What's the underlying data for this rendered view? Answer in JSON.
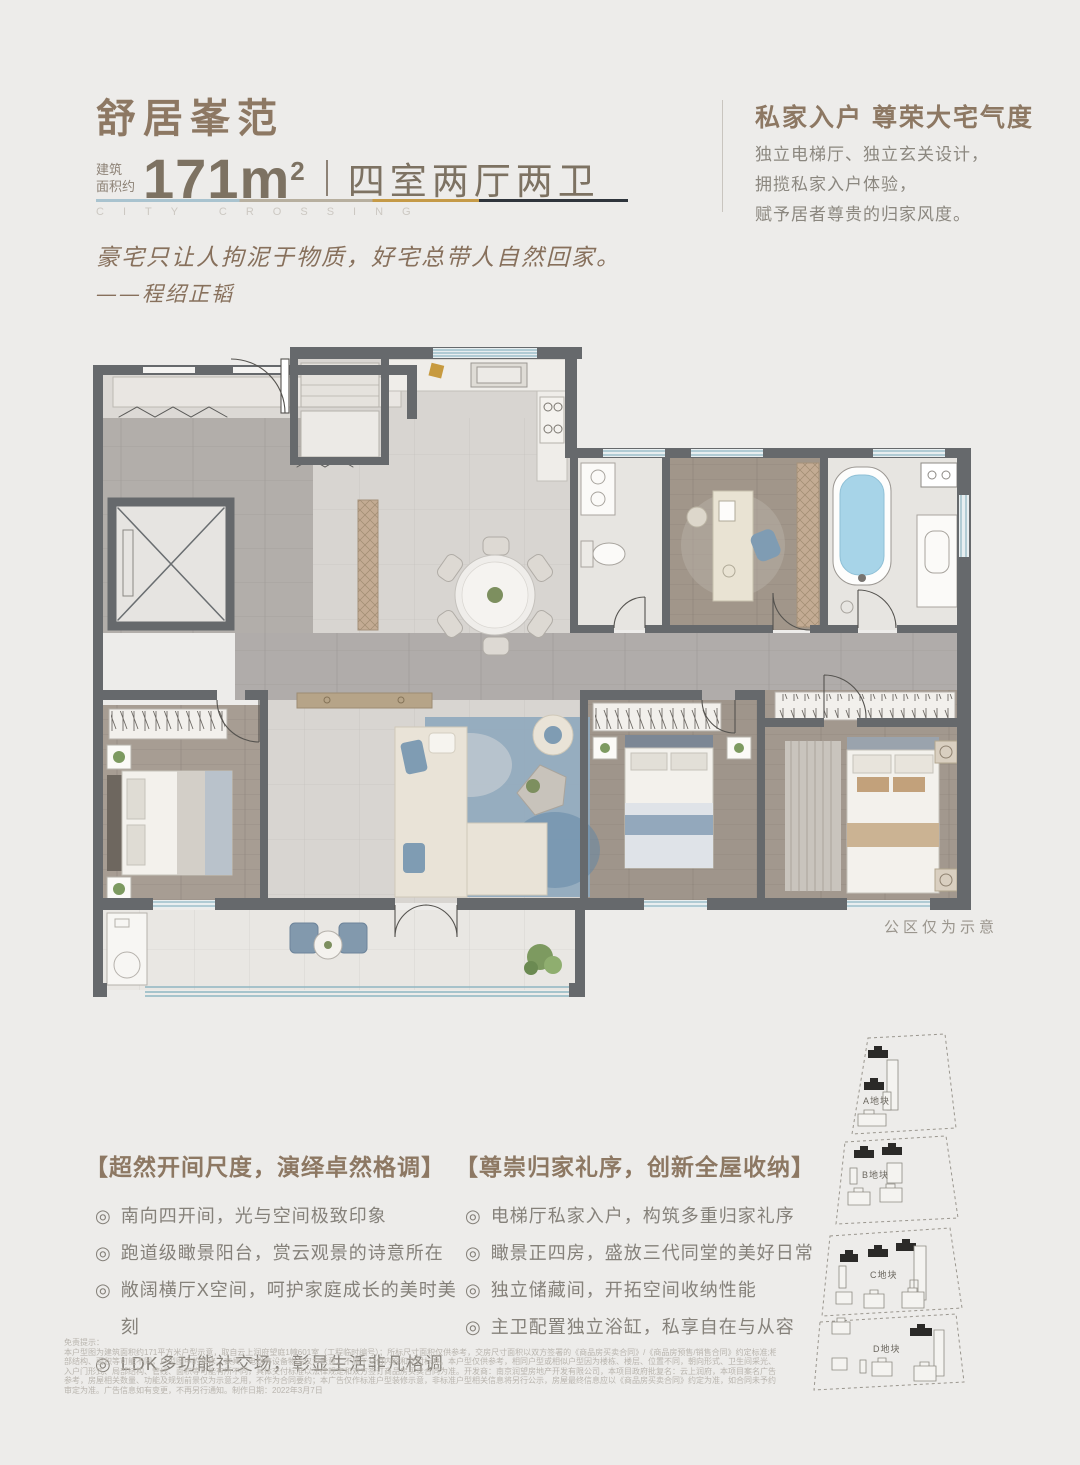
{
  "header": {
    "title": "舒居峯范",
    "area_prefix_line1": "建筑",
    "area_prefix_line2": "面积约",
    "area_value": "171m",
    "area_sup": "2",
    "layout": "四室两厅两卫",
    "watermark": "CITY CROSSING",
    "quote": "豪宅只让人拘泥于物质，好宅总带人自然回家。",
    "quote_author": "——程绍正韬"
  },
  "highlight": {
    "title": "私家入户 尊荣大宅气度",
    "line1": "独立电梯厅、独立玄关设计，",
    "line2": "拥揽私家入户体验，",
    "line3": "赋予居者尊贵的归家风度。"
  },
  "floorplan": {
    "note": "公区仅为示意"
  },
  "features_left": {
    "title": "【超然开间尺度，演绎卓然格调】",
    "bullet": "◎",
    "items": [
      "南向四开间，光与空间极致印象",
      "跑道级瞰景阳台，赏云观景的诗意所在",
      "敞阔横厅X空间，呵护家庭成长的美时美刻",
      "LDK多功能社交场，彰显生活非凡格调"
    ]
  },
  "features_right": {
    "title": "【尊崇归家礼序，创新全屋收纳】",
    "bullet": "◎",
    "items": [
      "电梯厅私家入户，构筑多重归家礼序",
      "瞰景正四房，盛放三代同堂的美好日常",
      "独立储藏间，开拓空间收纳性能",
      "主卫配置独立浴缸，私享自在与从容"
    ]
  },
  "sitemap": {
    "parcels": [
      "A地块",
      "B地块",
      "C地块",
      "D地块"
    ]
  },
  "disclaimer": {
    "title": "免责提示：",
    "lines": [
      "本户型图为建筑面积约171平方米户型示意，取自云上润府望庭1幢601室（工程临时编号）；所标尺寸面积仅供参考，交房尺寸面积以双方签署的《商品房买卖合同》/《商品房预售/销售合同》约定标准;相同户型因楼栋、楼层、单元等差异，局",
      "部结构、面积等可能不同，户型图中的装修、家具、电器等设备物品仅为示意，不属于交付内容和交付标准。本户型仅供参考，相同户型或相似户型因为楼栋、楼层、位置不同，朝向形式、卫生间采光、空调机位、剪力墙厚度、无障碍设计，",
      "入户门形式、局部结构、管线、面积等可能有所不同，具体交付标准以法律规定和双方签订商品房买卖合同为准。开发商：南京润望房地产开发有限公司，本项目政府批复名：云上润府，本项目案名广告：云上润府，本广告所有图片及文字仅供",
      "参考，房屋相关数量、功能及规划前景仅为示意之用，不作为合同要约；本广告仅作标准户型装修示意，非标准户型相关信息将另行公示，房屋最终信息应以《商品房买卖合同》约定为准，如合同未予约定，则以房屋最终实际状况及政府最后",
      "审定为准。广告信息如有变更，不再另行通知。制作日期：2022年3月7日"
    ]
  },
  "colors": {
    "accent_brown": "#8d7863",
    "text_gray": "#8b877f",
    "line_blue": "#a9c3cf",
    "line_beige": "#b7af9f",
    "line_gold": "#c59a47",
    "line_dark": "#2f353c",
    "wall": "#66696c",
    "window_teal": "#8fb6c2"
  }
}
